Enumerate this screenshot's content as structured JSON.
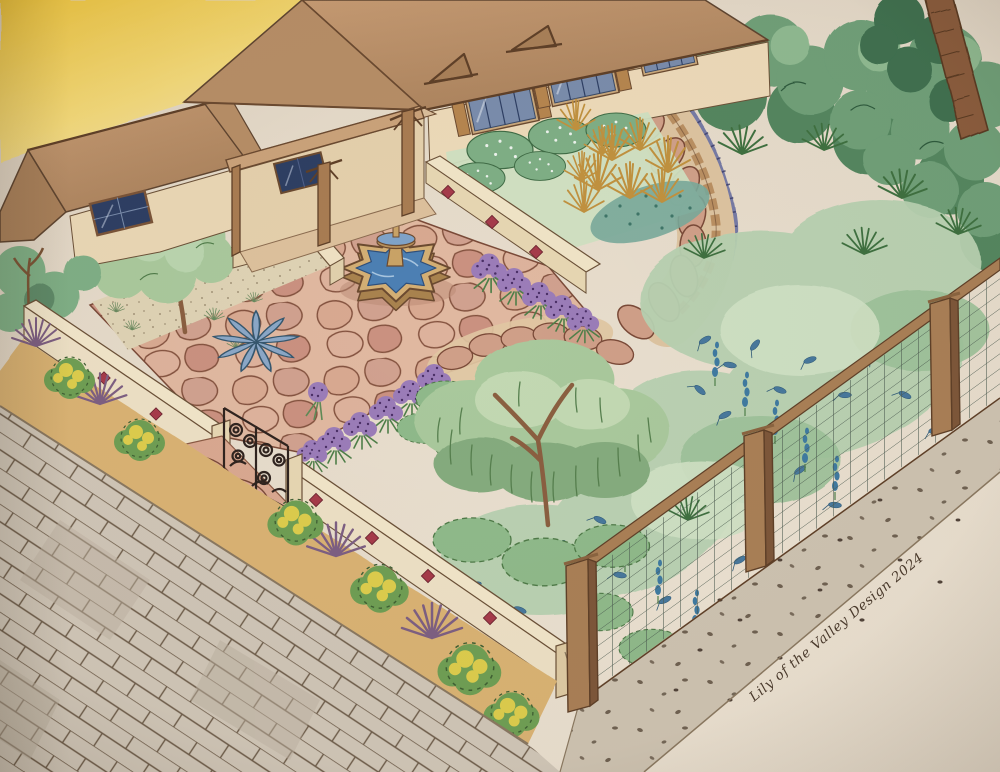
{
  "artwork": {
    "signature": "Lily of the Valley Design 2024",
    "description": "Watercolor and ink bird's-eye landscape design rendering of a home garden with courtyard fountain, curved stepping-stone path, lavender borders, low stucco walls with red tile accents, wire fence and street-side planting strip"
  },
  "palette": {
    "paper": "#e8decf",
    "sky_wash": "#ecc94f",
    "roof": "#b68d66",
    "wall_cream": "#ecd9b8",
    "window_blue": "#7a8cab",
    "window_dark": "#2e3f63",
    "flagstone": "#d8a890",
    "flag_line": "#7d4b38",
    "water": "#4c7fb3",
    "water_jet": "#5d88b8",
    "fountain_stone": "#d3ae74",
    "lavender": "#9b7cb8",
    "hedge": "#6f9f78",
    "foliage": "#a9c89c",
    "gold": "#c0913f",
    "agave": "#8ba7c6",
    "shrub_yellow": "#e2cf4d",
    "purple_grass": "#7d5f82",
    "garden_wall": "#ecdfc4",
    "tile_red": "#a53b4a",
    "iron": "#30241f",
    "wood": "#a97f56",
    "path_tan": "#dcc3a0",
    "sidewalk": "#cfc5b6",
    "gravel": "#cdc2b0",
    "strip_soil": "#d9b273",
    "ink": "#4a3a2c"
  },
  "scene": {
    "elements": [
      "sunset-sky-wash",
      "main-house-with-porch",
      "garage-wing",
      "tiered-fountain",
      "flagstone-courtyard",
      "lavender-borders",
      "blue-agave",
      "shade-tree",
      "willow-tree",
      "raised-perennial-bed",
      "stepping-stone-path",
      "blue-flower-border",
      "background-hedge",
      "palm-trunk",
      "low-stucco-wall-with-tile-accents",
      "wrought-iron-gate",
      "street-planting-strip",
      "paver-sidewalk",
      "wire-and-wood-fence",
      "gravel-side-path",
      "artist-signature"
    ]
  }
}
